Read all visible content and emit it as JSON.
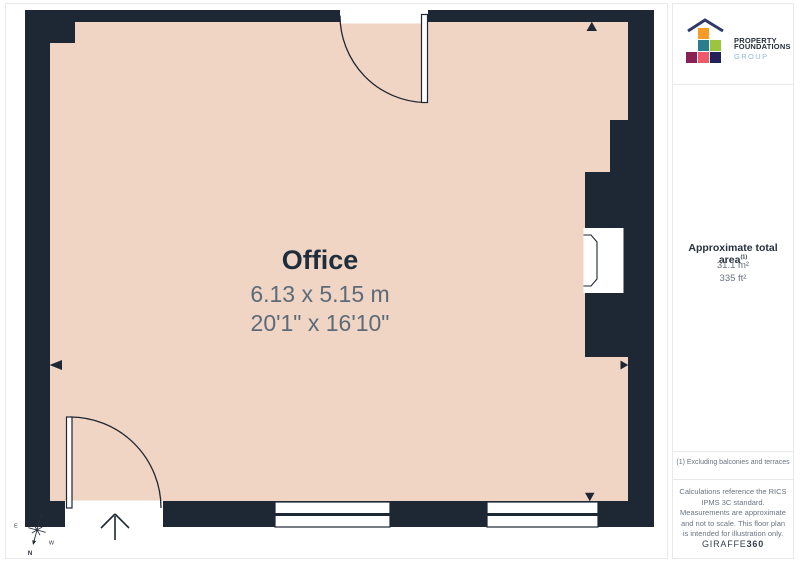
{
  "page": {
    "colors": {
      "wall": "#1E2734",
      "floor": "#F0D5C4",
      "border": "#E9E9EB"
    }
  },
  "floorplan": {
    "room": {
      "name": "Office",
      "dimensions_metric": "6.13 x 5.15 m",
      "dimensions_imperial": "20'1\" x 16'10\""
    },
    "compass": {
      "north": "N",
      "south": "S",
      "east": "E",
      "west": "W"
    }
  },
  "sidebar": {
    "logo": {
      "name_line1": "PROPERTY",
      "name_line2": "FOUNDATIONS",
      "name_line3": "GROUP"
    },
    "area": {
      "title": "Approximate total area",
      "footnote_marker": "(1)",
      "metric_value": "31.1 m²",
      "imperial_value": "335 ft²"
    },
    "footnote": "(1) Excluding balconies and terraces",
    "disclaimer": "Calculations reference the RICS IPMS 3C standard. Measurements are approximate and not to scale. This floor plan is intended for illustration only.",
    "brand": {
      "name": "GIRAFFE",
      "suffix": "360"
    }
  }
}
